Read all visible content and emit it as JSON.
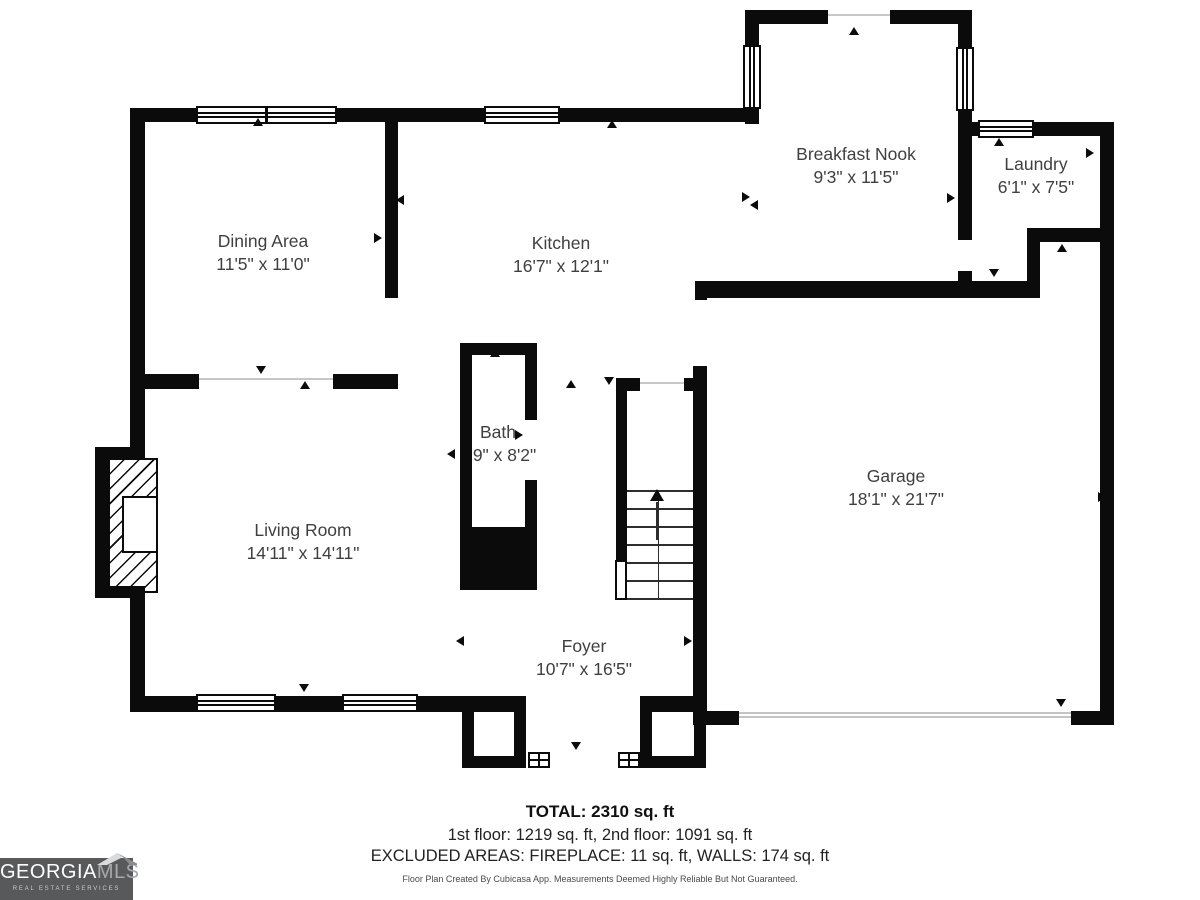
{
  "rooms": [
    {
      "name": "Dining Area",
      "dims": "11'5\" x 11'0\""
    },
    {
      "name": "Kitchen",
      "dims": "16'7\" x 12'1\""
    },
    {
      "name": "Breakfast Nook",
      "dims": "9'3\" x 11'5\""
    },
    {
      "name": "Laundry",
      "dims": "6'1\" x 7'5\""
    },
    {
      "name": "Bath",
      "dims": "2'9\" x 8'2\""
    },
    {
      "name": "Living Room",
      "dims": "14'11\" x 14'11\""
    },
    {
      "name": "Garage",
      "dims": "18'1\" x 21'7\""
    },
    {
      "name": "Foyer",
      "dims": "10'7\" x 16'5\""
    }
  ],
  "summary": {
    "total": "TOTAL: 2310 sq. ft",
    "floors": "1st floor: 1219 sq. ft, 2nd floor: 1091 sq. ft",
    "excluded": "EXCLUDED AREAS: FIREPLACE: 11 sq. ft, WALLS: 174 sq. ft",
    "disclaimer": "Floor Plan Created By Cubicasa App. Measurements Deemed Highly Reliable But Not Guaranteed."
  },
  "branding": {
    "name_primary": "GEORGIA",
    "name_secondary": "MLS",
    "tagline": "REAL ESTATE SERVICES"
  },
  "colors": {
    "wall": "#0b0b0b",
    "label_text": "#3f3f3f",
    "logo_background": "#58595b",
    "logo_secondary_text": "#a7a9ac"
  }
}
